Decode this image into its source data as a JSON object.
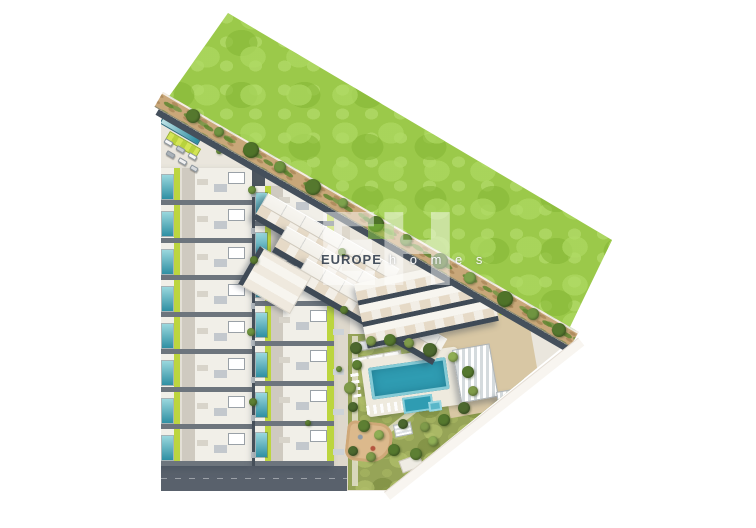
{
  "watermark": {
    "monogram": "EH",
    "brand": "EUROPE",
    "brand_suffix": "h o m e s",
    "brand_color": "#202d3e",
    "accent_green": "#86c53f"
  },
  "colors": {
    "field_green": "#9bc94a",
    "path_tan": "#c9a779",
    "ground_beige": "#eae6dd",
    "road_dark": "#4d565f",
    "road_mid_light": "#ded8cc",
    "road_bottom": "#59616c",
    "pool_teal": "#2f9cb2",
    "lawn_lime": "#bcd53f",
    "garden_olive": "#96a457",
    "roof_white": "#f1efe8",
    "terrace_beige": "#e6dac7",
    "plaza_beige": "#d8c7a4",
    "playground_sand": "#dcb98c",
    "gap_shadow": "#6d757d",
    "apt_gap": "#3f4a56"
  },
  "site": {
    "townhouse_rows_left": 8,
    "townhouse_rows_middle": 7,
    "apartment_rows_upper": 3,
    "path_trees": [
      {
        "x": 186,
        "y": 109,
        "r": 7,
        "c": "#55782e"
      },
      {
        "x": 214,
        "y": 127,
        "r": 5,
        "c": "#6f9440"
      },
      {
        "x": 243,
        "y": 142,
        "r": 8,
        "c": "#4f7329"
      },
      {
        "x": 274,
        "y": 161,
        "r": 6,
        "c": "#6f9440"
      },
      {
        "x": 305,
        "y": 179,
        "r": 8,
        "c": "#55782e"
      },
      {
        "x": 338,
        "y": 198,
        "r": 5,
        "c": "#7da24c"
      },
      {
        "x": 368,
        "y": 216,
        "r": 8,
        "c": "#4f7329"
      },
      {
        "x": 400,
        "y": 234,
        "r": 6,
        "c": "#6f9440"
      },
      {
        "x": 432,
        "y": 253,
        "r": 8,
        "c": "#55782e"
      },
      {
        "x": 464,
        "y": 272,
        "r": 6,
        "c": "#7da24c"
      },
      {
        "x": 497,
        "y": 291,
        "r": 8,
        "c": "#4f7329"
      },
      {
        "x": 527,
        "y": 308,
        "r": 6,
        "c": "#6f9440"
      },
      {
        "x": 552,
        "y": 323,
        "r": 7,
        "c": "#55782e"
      }
    ],
    "garden_trees": [
      {
        "x": 350,
        "y": 342,
        "r": 6,
        "c": "#4c682e"
      },
      {
        "x": 366,
        "y": 336,
        "r": 5,
        "c": "#7f9b4a"
      },
      {
        "x": 384,
        "y": 334,
        "r": 6,
        "c": "#55782e"
      },
      {
        "x": 404,
        "y": 338,
        "r": 5,
        "c": "#7f9b4a"
      },
      {
        "x": 423,
        "y": 343,
        "r": 7,
        "c": "#4c682e"
      },
      {
        "x": 448,
        "y": 352,
        "r": 5,
        "c": "#8fae55"
      },
      {
        "x": 462,
        "y": 366,
        "r": 6,
        "c": "#55782e"
      },
      {
        "x": 468,
        "y": 386,
        "r": 5,
        "c": "#7f9b4a"
      },
      {
        "x": 458,
        "y": 402,
        "r": 6,
        "c": "#4c682e"
      },
      {
        "x": 352,
        "y": 360,
        "r": 5,
        "c": "#5d7f33"
      },
      {
        "x": 344,
        "y": 382,
        "r": 6,
        "c": "#7f9b4a"
      },
      {
        "x": 348,
        "y": 402,
        "r": 5,
        "c": "#4c682e"
      },
      {
        "x": 358,
        "y": 420,
        "r": 6,
        "c": "#5d7f33"
      },
      {
        "x": 438,
        "y": 414,
        "r": 6,
        "c": "#55782e"
      },
      {
        "x": 420,
        "y": 422,
        "r": 5,
        "c": "#7f9b4a"
      },
      {
        "x": 398,
        "y": 419,
        "r": 5,
        "c": "#4c682e"
      },
      {
        "x": 374,
        "y": 430,
        "r": 5,
        "c": "#8fae55"
      },
      {
        "x": 388,
        "y": 444,
        "r": 6,
        "c": "#55782e"
      },
      {
        "x": 366,
        "y": 452,
        "r": 5,
        "c": "#7f9b4a"
      },
      {
        "x": 348,
        "y": 446,
        "r": 5,
        "c": "#4c682e"
      },
      {
        "x": 410,
        "y": 448,
        "r": 6,
        "c": "#5d7f33"
      },
      {
        "x": 428,
        "y": 436,
        "r": 5,
        "c": "#8fae55"
      }
    ],
    "bushes": [
      {
        "x": 248,
        "y": 186,
        "r": 4,
        "c": "#6f9440"
      },
      {
        "x": 250,
        "y": 256,
        "r": 4,
        "c": "#5d7f33"
      },
      {
        "x": 247,
        "y": 328,
        "r": 4,
        "c": "#6f9440"
      },
      {
        "x": 249,
        "y": 398,
        "r": 4,
        "c": "#5d7f33"
      },
      {
        "x": 338,
        "y": 248,
        "r": 4,
        "c": "#6f9440"
      },
      {
        "x": 340,
        "y": 306,
        "r": 4,
        "c": "#5d7f33"
      },
      {
        "x": 336,
        "y": 366,
        "r": 3,
        "c": "#6f9440"
      },
      {
        "x": 216,
        "y": 148,
        "r": 3,
        "c": "#6f9440"
      },
      {
        "x": 305,
        "y": 420,
        "r": 3,
        "c": "#5d7f33"
      }
    ],
    "cars": [
      {
        "x": 164,
        "y": 140,
        "w": 9,
        "h": 5,
        "c": "#f5f5f5"
      },
      {
        "x": 176,
        "y": 147,
        "w": 9,
        "h": 5,
        "c": "#c7ccd1"
      },
      {
        "x": 188,
        "y": 154,
        "w": 9,
        "h": 5,
        "c": "#f5f5f5"
      },
      {
        "x": 166,
        "y": 152,
        "w": 9,
        "h": 5,
        "c": "#aab2b8"
      },
      {
        "x": 178,
        "y": 159,
        "w": 9,
        "h": 5,
        "c": "#f0f0f0"
      },
      {
        "x": 190,
        "y": 166,
        "w": 8,
        "h": 5,
        "c": "#d7dadd"
      }
    ]
  }
}
